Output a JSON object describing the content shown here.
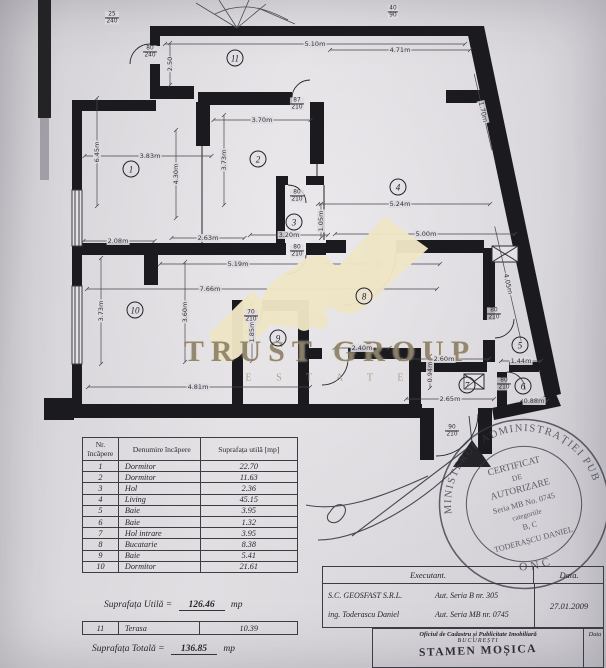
{
  "watermark": {
    "brand": "TRUST GROUP",
    "sub": "E S T A T E"
  },
  "plan": {
    "rooms": [
      {
        "n": "11",
        "x": 235,
        "y": 58
      },
      {
        "n": "1",
        "x": 131,
        "y": 169
      },
      {
        "n": "2",
        "x": 258,
        "y": 159
      },
      {
        "n": "3",
        "x": 294,
        "y": 222
      },
      {
        "n": "4",
        "x": 398,
        "y": 187
      },
      {
        "n": "5",
        "x": 520,
        "y": 345
      },
      {
        "n": "6",
        "x": 523,
        "y": 386
      },
      {
        "n": "7",
        "x": 467,
        "y": 385
      },
      {
        "n": "8",
        "x": 364,
        "y": 296
      },
      {
        "n": "9",
        "x": 278,
        "y": 338
      },
      {
        "n": "10",
        "x": 135,
        "y": 310
      }
    ],
    "dims": [
      {
        "t": "5.10m",
        "x": 315,
        "y": 44,
        "o": "h",
        "l": 300
      },
      {
        "t": "4.71m",
        "x": 400,
        "y": 50,
        "o": "h",
        "l": 140
      },
      {
        "t": "2.50",
        "x": 170,
        "y": 64,
        "o": "v",
        "l": 42
      },
      {
        "t": "1.70m",
        "x": 483,
        "y": 112,
        "o": "d",
        "l": 78
      },
      {
        "t": "3.83m",
        "x": 150,
        "y": 156,
        "o": "h",
        "l": 127,
        "lx": 148
      },
      {
        "t": "3.70m",
        "x": 262,
        "y": 120,
        "o": "h",
        "l": 97
      },
      {
        "t": "6.45m",
        "x": 97,
        "y": 152,
        "o": "v",
        "l": 108
      },
      {
        "t": "3.73m",
        "x": 224,
        "y": 160,
        "o": "v",
        "l": 90
      },
      {
        "t": "4.30m",
        "x": 176,
        "y": 174,
        "o": "v",
        "l": 88
      },
      {
        "t": "5.24m",
        "x": 400,
        "y": 204,
        "o": "h",
        "l": 172,
        "lx": 404
      },
      {
        "t": "5.00m",
        "x": 426,
        "y": 234,
        "o": "h",
        "l": 180,
        "lx": 425
      },
      {
        "t": "2.08m",
        "x": 118,
        "y": 241,
        "o": "h",
        "l": 71,
        "lx": 119
      },
      {
        "t": "2.63m",
        "x": 208,
        "y": 238,
        "o": "h",
        "l": 73
      },
      {
        "t": "3.20m",
        "x": 289,
        "y": 235,
        "o": "h",
        "l": 78
      },
      {
        "t": "1.05m",
        "x": 321,
        "y": 221,
        "o": "v",
        "l": 34
      },
      {
        "t": "5.19m",
        "x": 238,
        "y": 264,
        "o": "h",
        "l": 280,
        "lx": 300
      },
      {
        "t": "7.66m",
        "x": 210,
        "y": 289,
        "o": "h",
        "l": 350,
        "lx": 262
      },
      {
        "t": "3.73m",
        "x": 101,
        "y": 311,
        "o": "v",
        "l": 106
      },
      {
        "t": "3.60m",
        "x": 185,
        "y": 312,
        "o": "v",
        "l": 100
      },
      {
        "t": "1.85m",
        "x": 252,
        "y": 332,
        "o": "v",
        "l": 58
      },
      {
        "t": "2.40m",
        "x": 362,
        "y": 348,
        "o": "h",
        "l": 55
      },
      {
        "t": "0.94m",
        "x": 430,
        "y": 372,
        "o": "v",
        "l": 32
      },
      {
        "t": "4.81m",
        "x": 198,
        "y": 387,
        "o": "h",
        "l": 222,
        "lx": 199
      },
      {
        "t": "2.60m",
        "x": 444,
        "y": 359,
        "o": "h",
        "l": 88,
        "lx": 445
      },
      {
        "t": "1.44m",
        "x": 521,
        "y": 361,
        "o": "h",
        "l": 40
      },
      {
        "t": "2.65m",
        "x": 450,
        "y": 399,
        "o": "h",
        "l": 88
      },
      {
        "t": "0.88m",
        "x": 534,
        "y": 401,
        "o": "h",
        "l": 26
      },
      {
        "t": "4.05m",
        "x": 508,
        "y": 284,
        "o": "d",
        "l": 118
      }
    ],
    "fracs": [
      {
        "a": "80",
        "b": "240",
        "x": 150,
        "y": 52
      },
      {
        "a": "25",
        "b": "240",
        "x": 112,
        "y": 18
      },
      {
        "a": "40",
        "b": "90",
        "x": 393,
        "y": 12
      },
      {
        "a": "87",
        "b": "210",
        "x": 297,
        "y": 104
      },
      {
        "a": "80",
        "b": "210",
        "x": 297,
        "y": 196
      },
      {
        "a": "80",
        "b": "210",
        "x": 297,
        "y": 251
      },
      {
        "a": "70",
        "b": "210",
        "x": 251,
        "y": 316
      },
      {
        "a": "80",
        "b": "210",
        "x": 494,
        "y": 314
      },
      {
        "a": "80",
        "b": "210",
        "x": 504,
        "y": 384
      },
      {
        "a": "90",
        "b": "210",
        "x": 452,
        "y": 431
      }
    ]
  },
  "area_table": {
    "headers": {
      "col1": "Nr. încăpere",
      "col2": "Denumire încăpere",
      "col3": "Suprafața utilă [mp]"
    },
    "rows": [
      [
        "1",
        "Dormitor",
        "22.70"
      ],
      [
        "2",
        "Dormitor",
        "11.63"
      ],
      [
        "3",
        "Hol",
        "2.36"
      ],
      [
        "4",
        "Living",
        "45.15"
      ],
      [
        "5",
        "Baie",
        "3.95"
      ],
      [
        "6",
        "Baie",
        "1.32"
      ],
      [
        "7",
        "Hol intrare",
        "3.95"
      ],
      [
        "8",
        "Bucatarie",
        "8.38"
      ],
      [
        "9",
        "Baie",
        "5.41"
      ],
      [
        "10",
        "Dormitor",
        "21.61"
      ]
    ],
    "util_label": "Suprafața Utilă =",
    "util_value": "126.46",
    "util_unit": "mp",
    "terasa_row": [
      "11",
      "Terasa",
      "10.39"
    ],
    "total_label": "Suprafața Totală =",
    "total_value": "136.85",
    "total_unit": "mp"
  },
  "exec_table": {
    "executant_label": "Executant.",
    "data_label": "Data.",
    "company": "S.C.  GEOSFAST  S.R.L.",
    "company_aut": "Aut.  Seria B nr. 305",
    "engineer": "ing.  Toderascu Daniel",
    "engineer_aut": "Aut.  Seria MB nr. 0745",
    "date": "27.01.2009",
    "office_line": "Oficiul de Cadastru și Publicitate Imobiliară",
    "office_city": "BUCUREȘTI",
    "office_data_label": "Data",
    "receiver": "STAMEN MOȘICA"
  },
  "stamp": {
    "ring_top": "MINISTERUL ADMINISTRAȚIEI PUBLICE",
    "ring_bottom": "ONC",
    "lines": [
      "CERTIFICAT",
      "DE",
      "AUTORIZARE",
      "Seria MB No. 0745",
      "categoriile",
      "B, C",
      "TODERAȘCU DANIEL"
    ]
  }
}
